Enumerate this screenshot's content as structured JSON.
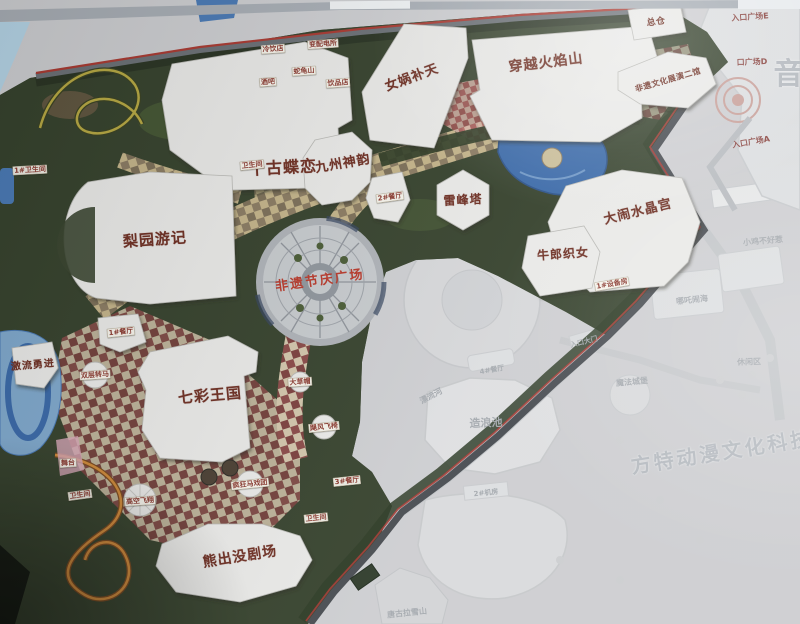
{
  "map": {
    "colors": {
      "label_red": "#6e2f23",
      "plaza_red": "#b8392b",
      "chip_red": "#8a3a30",
      "faint_gray": "#a4a9ae",
      "foliage_green": "#36432d",
      "water_blue": "#3a69a8",
      "paving_tan": "#cfc09a",
      "paving_maroon": "#8a4a48",
      "board_gray": "#cdced1"
    },
    "labels": {
      "attractions": [
        {
          "id": "qiangu-dielian",
          "text": "千古蝶恋",
          "x": 283,
          "y": 168,
          "fs": 16,
          "rot": -3
        },
        {
          "id": "nvwa-butian",
          "text": "女娲补天",
          "x": 412,
          "y": 78,
          "fs": 13,
          "rot": -20
        },
        {
          "id": "chuanyue-huoyanshan",
          "text": "穿越火焰山",
          "x": 546,
          "y": 63,
          "fs": 14,
          "rot": -7
        },
        {
          "id": "jiuzhou-shenyun",
          "text": "九州神韵",
          "x": 343,
          "y": 164,
          "fs": 13,
          "rot": -10
        },
        {
          "id": "leifengta",
          "text": "雷峰塔",
          "x": 463,
          "y": 200,
          "fs": 12,
          "rot": -3
        },
        {
          "id": "danao-shuijinggong",
          "text": "大闹水晶宫",
          "x": 638,
          "y": 212,
          "fs": 13,
          "rot": -14
        },
        {
          "id": "niulang-zhinv",
          "text": "牛郎织女",
          "x": 563,
          "y": 254,
          "fs": 12,
          "rot": -4
        },
        {
          "id": "liyuan-youji",
          "text": "梨园游记",
          "x": 155,
          "y": 240,
          "fs": 15,
          "rot": -4
        },
        {
          "id": "qicai-wangguo",
          "text": "七彩王国",
          "x": 210,
          "y": 396,
          "fs": 15,
          "rot": -5
        },
        {
          "id": "xiongchumo-juchang",
          "text": "熊出没剧场",
          "x": 240,
          "y": 557,
          "fs": 14,
          "rot": -9
        },
        {
          "id": "jiliu-yongjin",
          "text": "激流勇进",
          "x": 33,
          "y": 366,
          "fs": 10,
          "rot": -5
        },
        {
          "id": "zongcang",
          "text": "总仓",
          "x": 656,
          "y": 22,
          "fs": 9,
          "rot": -8
        },
        {
          "id": "feiyi-zhanyan-erguan",
          "text": "非遗文化展演二馆",
          "x": 668,
          "y": 80,
          "fs": 8,
          "rot": -16
        }
      ],
      "plaza": [
        {
          "id": "feiyi-jieqing-guangchang",
          "text": "非遗节庆广场",
          "x": 320,
          "y": 281,
          "fs": 13,
          "rot": -8
        }
      ],
      "facilities": [
        {
          "id": "canting-2",
          "text": "2#餐厅",
          "x": 390,
          "y": 197,
          "fs": 7,
          "rot": -8
        },
        {
          "id": "canting-1",
          "text": "1#餐厅",
          "x": 121,
          "y": 332,
          "fs": 7,
          "rot": -6
        },
        {
          "id": "canting-3",
          "text": "3#餐厅",
          "x": 347,
          "y": 481,
          "fs": 7,
          "rot": -6
        },
        {
          "id": "shuangceng-zhuanma",
          "text": "双层转马",
          "x": 95,
          "y": 375,
          "fs": 7,
          "rot": -4
        },
        {
          "id": "wutai",
          "text": "舞台",
          "x": 68,
          "y": 463,
          "fs": 7,
          "rot": -4
        },
        {
          "id": "gaokong-feixiang",
          "text": "高空飞翔",
          "x": 140,
          "y": 501,
          "fs": 7,
          "rot": -4
        },
        {
          "id": "fengkuang-maxituan",
          "text": "疯狂马戏团",
          "x": 250,
          "y": 484,
          "fs": 7,
          "rot": -6
        },
        {
          "id": "jufeng-feiyi",
          "text": "飓风飞椅",
          "x": 324,
          "y": 427,
          "fs": 7,
          "rot": -6
        },
        {
          "id": "dacaomao",
          "text": "大草帽",
          "x": 300,
          "y": 382,
          "fs": 7,
          "rot": -4
        },
        {
          "id": "weishengjian-1",
          "text": "1#卫生间",
          "x": 30,
          "y": 170,
          "fs": 7,
          "rot": -3
        },
        {
          "id": "weishengjian-2",
          "text": "卫生间",
          "x": 252,
          "y": 165,
          "fs": 7,
          "rot": -6
        },
        {
          "id": "weishengjian-3",
          "text": "卫生间",
          "x": 80,
          "y": 495,
          "fs": 7,
          "rot": -8
        },
        {
          "id": "weishengjian-4",
          "text": "卫生间",
          "x": 316,
          "y": 518,
          "fs": 7,
          "rot": -6
        },
        {
          "id": "shebeifang-1",
          "text": "1#设备房",
          "x": 612,
          "y": 284,
          "fs": 7,
          "rot": -10
        },
        {
          "id": "lengyindian",
          "text": "冷饮店",
          "x": 273,
          "y": 49,
          "fs": 7,
          "rot": -4
        },
        {
          "id": "bianpeidiansuo",
          "text": "变配电所",
          "x": 323,
          "y": 44,
          "fs": 7,
          "rot": -4
        },
        {
          "id": "shegui-shan",
          "text": "蛇龟山",
          "x": 304,
          "y": 71,
          "fs": 7,
          "rot": -4
        },
        {
          "id": "jiuba",
          "text": "酒吧",
          "x": 268,
          "y": 82,
          "fs": 7,
          "rot": -4
        },
        {
          "id": "yinpindian",
          "text": "饮品店",
          "x": 338,
          "y": 83,
          "fs": 7,
          "rot": -4
        }
      ],
      "entrances": [
        {
          "id": "rukou-guangchang-e",
          "text": "入口广场E",
          "x": 750,
          "y": 17,
          "fs": 8,
          "rot": -4
        },
        {
          "id": "rukou-guangchang-d",
          "text": "口广场D",
          "x": 752,
          "y": 62,
          "fs": 8,
          "rot": -2
        },
        {
          "id": "rukou-guangchang-a",
          "text": "入口广场A",
          "x": 751,
          "y": 142,
          "fs": 8,
          "rot": -10
        }
      ],
      "faint_area": [
        {
          "id": "xiaoji-buhaore",
          "text": "小鸡不好惹",
          "x": 763,
          "y": 241,
          "fs": 8,
          "rot": -5
        },
        {
          "id": "nezha-naohai",
          "text": "哪吒闹海",
          "x": 692,
          "y": 300,
          "fs": 8,
          "rot": -6
        },
        {
          "id": "xiuxianqu",
          "text": "休闲区",
          "x": 749,
          "y": 362,
          "fs": 8,
          "rot": -2
        },
        {
          "id": "mofa-chengbao",
          "text": "魔法城堡",
          "x": 632,
          "y": 382,
          "fs": 8,
          "rot": -5
        },
        {
          "id": "zaolangchi",
          "text": "造浪池",
          "x": 486,
          "y": 423,
          "fs": 11,
          "rot": -2
        },
        {
          "id": "piaoliuhe",
          "text": "漂流河",
          "x": 431,
          "y": 396,
          "fs": 8,
          "rot": -28
        },
        {
          "id": "canting-4",
          "text": "4#餐厅",
          "x": 492,
          "y": 370,
          "fs": 7,
          "rot": -10
        },
        {
          "id": "jifang-2",
          "text": "2#机房",
          "x": 486,
          "y": 493,
          "fs": 7,
          "rot": -6
        },
        {
          "id": "rukou-damen",
          "text": "入口大门",
          "x": 584,
          "y": 342,
          "fs": 7,
          "rot": -14
        },
        {
          "id": "tanggula-xueshan",
          "text": "唐古拉雪山",
          "x": 407,
          "y": 613,
          "fs": 8,
          "rot": -6
        }
      ],
      "watermarks": [
        {
          "id": "fangte-donman-wenhua-keji",
          "text": "方特动漫文化科技",
          "x": 722,
          "y": 452,
          "fs": 20,
          "rot": -9
        },
        {
          "id": "yin-char",
          "text": "音",
          "x": 790,
          "y": 75,
          "fs": 30,
          "rot": 0
        }
      ]
    }
  }
}
